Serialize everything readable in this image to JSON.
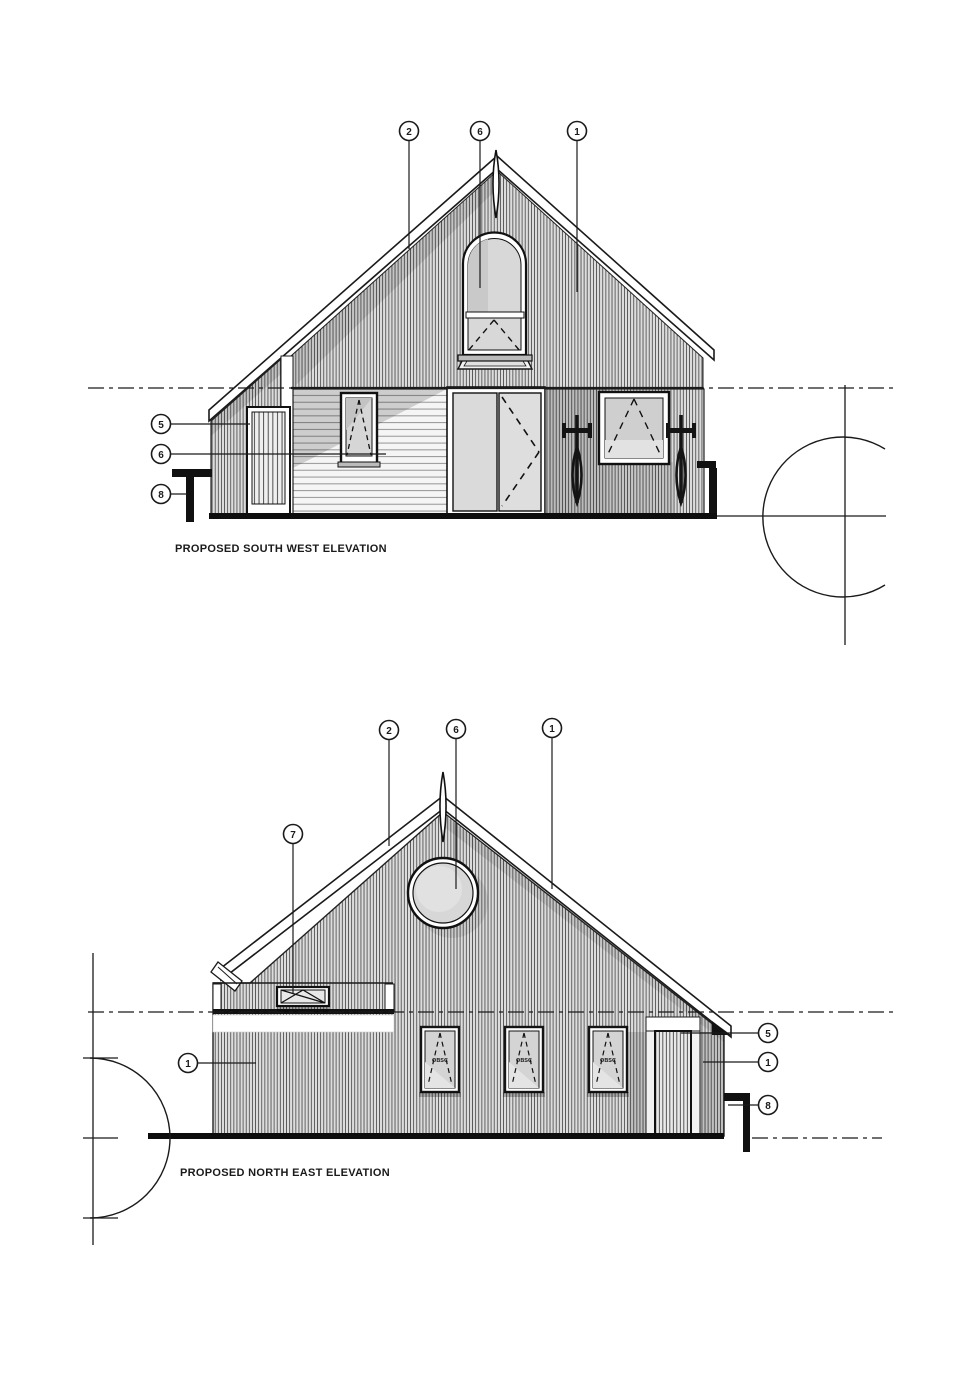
{
  "drawing": {
    "southwest": {
      "title": "PROPOSED SOUTH WEST ELEVATION",
      "markers": {
        "roof": "2",
        "arched_window": "6",
        "gable_cladding": "1",
        "side_door": "5",
        "horizontal_cladding": "6",
        "downpipe": "8"
      }
    },
    "northeast": {
      "title": "PROPOSED NORTH EAST ELEVATION",
      "markers": {
        "roof": "2",
        "round_window": "6",
        "gable_cladding": "1",
        "louvre": "7",
        "left_wall": "1",
        "eaves": "5",
        "right_wall": "1",
        "downpipe": "8"
      },
      "window_glazing_label": "OBSC"
    },
    "palette": {
      "line": "#1a1a1a",
      "background": "#ffffff",
      "cladding_gray": "#dcdcdc",
      "glass_gray": "#d6d6d6"
    }
  }
}
